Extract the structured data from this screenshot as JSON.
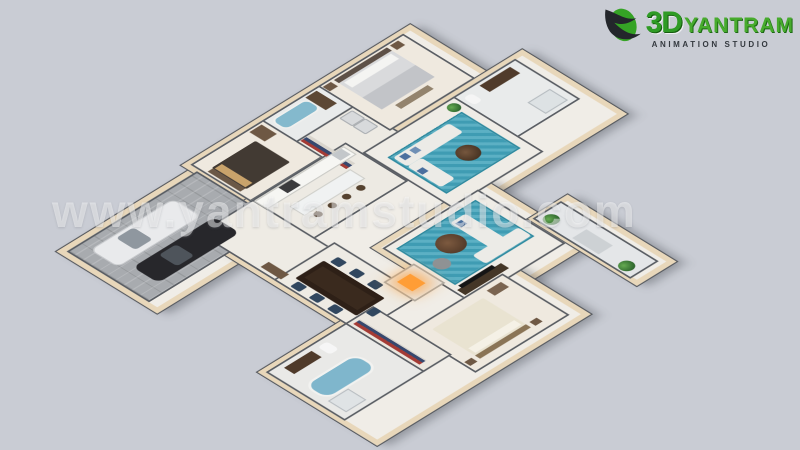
{
  "watermark": {
    "text": "www.yantramstudio.com"
  },
  "logo": {
    "number": "3D",
    "name": "YANTRAM",
    "tagline": "ANIMATION STUDIO"
  },
  "colors": {
    "background": "#c9ccd4",
    "exterior_wall": "#e8d7ba",
    "interior_wall": "#585c62",
    "floor_light": "#f0ede7",
    "garage_floor": "#a8abaf",
    "teal_rug": "#3f9cb3",
    "fire_glow": "#ff9d35",
    "logo_green": "#2f9b25",
    "watermark_white": "rgba(255,255,255,0.45)"
  },
  "scene": {
    "slabs": [
      {
        "name": "slab-garage-wing",
        "x": 20,
        "y": 15,
        "w": 270,
        "h": 178
      },
      {
        "name": "slab-bedroom-wing",
        "x": 280,
        "y": 0,
        "w": 430,
        "h": 192
      },
      {
        "name": "slab-family-wing",
        "x": 470,
        "y": 150,
        "w": 310,
        "h": 186
      },
      {
        "name": "slab-center-wing",
        "x": 180,
        "y": 118,
        "w": 300,
        "h": 332
      },
      {
        "name": "slab-living-wing",
        "x": 335,
        "y": 318,
        "w": 200,
        "h": 190
      },
      {
        "name": "slab-bottom-wing",
        "x": 25,
        "y": 405,
        "w": 400,
        "h": 215
      },
      {
        "name": "slab-porch",
        "x": 535,
        "y": 426,
        "w": 58,
        "h": 194
      }
    ],
    "rooms": [
      {
        "name": "room-garage",
        "x": 30,
        "y": 25,
        "w": 250,
        "h": 156,
        "cls": "pavers"
      },
      {
        "name": "room-bedroom-2",
        "x": 290,
        "y": 8,
        "w": 140,
        "h": 112,
        "bg": "#efe9df"
      },
      {
        "name": "room-bath-3",
        "x": 430,
        "y": 8,
        "w": 112,
        "h": 66,
        "bg": "#e9ebeb"
      },
      {
        "name": "room-laundry-hall",
        "x": 430,
        "y": 74,
        "w": 112,
        "h": 110,
        "bg": "#edeae3"
      },
      {
        "name": "room-master-bedroom",
        "x": 540,
        "y": 8,
        "w": 162,
        "h": 136,
        "bg": "#efe9df"
      },
      {
        "name": "room-bathroom-1",
        "x": 655,
        "y": 158,
        "w": 117,
        "h": 122,
        "bg": "#e9ebeb"
      },
      {
        "name": "room-family",
        "x": 478,
        "y": 158,
        "w": 174,
        "h": 170,
        "bg": "#efece6"
      },
      {
        "name": "room-kitchen",
        "x": 290,
        "y": 125,
        "w": 182,
        "h": 117,
        "bg": "#edeae3"
      },
      {
        "name": "room-entry-hall",
        "x": 188,
        "y": 125,
        "w": 102,
        "h": 212,
        "bg": "#eeebe4"
      },
      {
        "name": "room-dining",
        "x": 188,
        "y": 273,
        "w": 114,
        "h": 164,
        "bg": "#eeebe4"
      },
      {
        "name": "room-living",
        "x": 345,
        "y": 330,
        "w": 182,
        "h": 166,
        "bg": "#efece6"
      },
      {
        "name": "room-bedroom-3",
        "x": 238,
        "y": 488,
        "w": 179,
        "h": 126,
        "bg": "#efe9df"
      },
      {
        "name": "room-bathroom-2",
        "x": 33,
        "y": 413,
        "w": 155,
        "h": 149,
        "bg": "#e9e9e7"
      },
      {
        "name": "room-closet",
        "x": 188,
        "y": 413,
        "w": 50,
        "h": 149,
        "bg": "#ece8e0"
      },
      {
        "name": "room-porch",
        "x": 540,
        "y": 430,
        "w": 50,
        "h": 186,
        "bg": "#e4e6e8"
      }
    ],
    "furniture": [
      {
        "name": "car-white",
        "x": 55,
        "y": 45,
        "w": 160,
        "h": 52,
        "bg": "#e9eaec",
        "rad": 12,
        "border": "2px solid #c8cacd"
      },
      {
        "name": "car-white-windshield",
        "x": 100,
        "y": 52,
        "w": 34,
        "h": 38,
        "bg": "#8f979f",
        "rad": 6
      },
      {
        "name": "car-black",
        "x": 70,
        "y": 115,
        "w": 160,
        "h": 50,
        "bg": "#27272b",
        "rad": 12
      },
      {
        "name": "car-black-windshield",
        "x": 115,
        "y": 121,
        "w": 34,
        "h": 36,
        "bg": "#4e545b",
        "rad": 6
      },
      {
        "name": "bed-2-headboard",
        "x": 296,
        "y": 36,
        "w": 10,
        "h": 64,
        "bg": "#6b5846"
      },
      {
        "name": "bed-2",
        "x": 306,
        "y": 34,
        "w": 86,
        "h": 68,
        "bg": "#423a33",
        "rad": 3
      },
      {
        "name": "bed-2-pillows",
        "x": 308,
        "y": 38,
        "w": 14,
        "h": 60,
        "bg": "#c9a36b"
      },
      {
        "name": "bed-2-cabinet",
        "x": 400,
        "y": 14,
        "w": 24,
        "h": 30,
        "bg": "#6e5844"
      },
      {
        "name": "tub-3",
        "x": 438,
        "y": 16,
        "w": 66,
        "h": 26,
        "bg": "#84b9cd",
        "rad": 12,
        "border": "3px solid #f0f0ee"
      },
      {
        "name": "vanity-3",
        "x": 510,
        "y": 14,
        "w": 22,
        "h": 40,
        "bg": "#5c4734"
      },
      {
        "name": "closet-rack-top",
        "x": 436,
        "y": 78,
        "w": 18,
        "h": 90,
        "cls": "stripes"
      },
      {
        "name": "washer",
        "x": 510,
        "y": 80,
        "w": 22,
        "h": 22,
        "bg": "#d8dadc",
        "rad": 3,
        "border": "2px solid #a9adb1"
      },
      {
        "name": "dryer",
        "x": 510,
        "y": 106,
        "w": 22,
        "h": 22,
        "bg": "#d8dadc",
        "rad": 3,
        "border": "2px solid #a9adb1"
      },
      {
        "name": "master-bed-headboard",
        "x": 566,
        "y": 14,
        "w": 104,
        "h": 10,
        "bg": "#5d5047"
      },
      {
        "name": "master-bed",
        "x": 566,
        "y": 24,
        "w": 104,
        "h": 84,
        "bg": "#d9dadc",
        "rad": 3
      },
      {
        "name": "master-bed-pillows",
        "x": 572,
        "y": 28,
        "w": 92,
        "h": 16,
        "bg": "#f4f4f2"
      },
      {
        "name": "master-bed-blanket",
        "x": 566,
        "y": 70,
        "w": 104,
        "h": 38,
        "bg": "#c2c4c8"
      },
      {
        "name": "master-nightstand-left",
        "x": 544,
        "y": 14,
        "w": 16,
        "h": 14,
        "bg": "#6e5844"
      },
      {
        "name": "master-nightstand-right",
        "x": 676,
        "y": 14,
        "w": 16,
        "h": 14,
        "bg": "#6e5844"
      },
      {
        "name": "master-bench",
        "x": 586,
        "y": 114,
        "w": 64,
        "h": 12,
        "bg": "#93836d"
      },
      {
        "name": "vanity-1",
        "x": 700,
        "y": 166,
        "w": 60,
        "h": 20,
        "bg": "#503b2b"
      },
      {
        "name": "toilet-1",
        "x": 664,
        "y": 170,
        "w": 16,
        "h": 22,
        "bg": "#f5f5f5",
        "rad": 6
      },
      {
        "name": "shower-1",
        "x": 720,
        "y": 240,
        "w": 40,
        "h": 32,
        "bg": "#dde2e4",
        "border": "2px solid #b6bcc0"
      },
      {
        "name": "family-rug",
        "x": 495,
        "y": 190,
        "w": 140,
        "h": 110,
        "cls": "rug"
      },
      {
        "name": "family-sofa-long",
        "x": 500,
        "y": 196,
        "w": 110,
        "h": 28,
        "bg": "#ecebe7",
        "rad": 5
      },
      {
        "name": "family-sofa-side",
        "x": 500,
        "y": 224,
        "w": 28,
        "h": 66,
        "bg": "#ecebe7",
        "rad": 5
      },
      {
        "name": "family-pillow-1",
        "x": 508,
        "y": 200,
        "w": 12,
        "h": 12,
        "bg": "#4a6f9e"
      },
      {
        "name": "family-pillow-2",
        "x": 528,
        "y": 200,
        "w": 12,
        "h": 12,
        "bg": "#6f8fb5"
      },
      {
        "name": "family-pillow-3",
        "x": 502,
        "y": 240,
        "w": 12,
        "h": 12,
        "bg": "#4a6f9e"
      },
      {
        "name": "family-coffee-table",
        "x": 564,
        "y": 244,
        "w": 36,
        "h": 36,
        "rad": 18,
        "cls": "table-round"
      },
      {
        "name": "plant-family-corner",
        "x": 630,
        "y": 166,
        "w": 20,
        "h": 20,
        "cls": "plant"
      },
      {
        "name": "kitchen-counter",
        "x": 294,
        "y": 129,
        "w": 172,
        "h": 22,
        "bg": "#f6f6f3",
        "border": "2px solid #c9c9c4"
      },
      {
        "name": "kitchen-stove",
        "x": 340,
        "y": 131,
        "w": 26,
        "h": 18,
        "bg": "#3b3b3d"
      },
      {
        "name": "kitchen-fridge",
        "x": 444,
        "y": 131,
        "w": 20,
        "h": 18,
        "bg": "#c3c7ca"
      },
      {
        "name": "kitchen-island",
        "x": 320,
        "y": 172,
        "w": 116,
        "h": 26,
        "bg": "#f0f2f2",
        "border": "2px solid #cfcfca"
      },
      {
        "name": "bar-stool-1",
        "x": 330,
        "y": 206,
        "w": 13,
        "h": 13,
        "bg": "#55422f",
        "rad": 7
      },
      {
        "name": "bar-stool-2",
        "x": 358,
        "y": 206,
        "w": 13,
        "h": 13,
        "bg": "#55422f",
        "rad": 7
      },
      {
        "name": "bar-stool-3",
        "x": 386,
        "y": 206,
        "w": 13,
        "h": 13,
        "bg": "#55422f",
        "rad": 7
      },
      {
        "name": "bar-stool-4",
        "x": 414,
        "y": 206,
        "w": 13,
        "h": 13,
        "bg": "#55422f",
        "rad": 7
      },
      {
        "name": "entry-console",
        "x": 196,
        "y": 240,
        "w": 16,
        "h": 40,
        "bg": "#6e5844"
      },
      {
        "name": "dining-table",
        "x": 212,
        "y": 292,
        "w": 56,
        "h": 120,
        "bg": "#2e2017",
        "rad": 3
      },
      {
        "name": "dining-runner",
        "x": 222,
        "y": 300,
        "w": 36,
        "h": 104,
        "bg": "#3a2a1e"
      },
      {
        "name": "dining-chair-l1",
        "x": 194,
        "y": 300,
        "w": 16,
        "h": 18,
        "bg": "#31475f",
        "rad": 3
      },
      {
        "name": "dining-chair-l2",
        "x": 194,
        "y": 336,
        "w": 16,
        "h": 18,
        "bg": "#31475f",
        "rad": 3
      },
      {
        "name": "dining-chair-l3",
        "x": 194,
        "y": 372,
        "w": 16,
        "h": 18,
        "bg": "#31475f",
        "rad": 3
      },
      {
        "name": "dining-chair-r1",
        "x": 272,
        "y": 300,
        "w": 16,
        "h": 18,
        "bg": "#31475f",
        "rad": 3
      },
      {
        "name": "dining-chair-r2",
        "x": 272,
        "y": 336,
        "w": 16,
        "h": 18,
        "bg": "#31475f",
        "rad": 3
      },
      {
        "name": "dining-chair-r3",
        "x": 272,
        "y": 372,
        "w": 16,
        "h": 18,
        "bg": "#31475f",
        "rad": 3
      },
      {
        "name": "dining-chair-head",
        "x": 226,
        "y": 416,
        "w": 18,
        "h": 14,
        "bg": "#31475f",
        "rad": 3
      },
      {
        "name": "fireplace",
        "x": 292,
        "y": 385,
        "w": 54,
        "h": 56,
        "bg": "#e9e9e7",
        "border": "3px solid #a9a9a6",
        "z": 4
      },
      {
        "name": "fireplace-fire",
        "x": 306,
        "y": 398,
        "w": 26,
        "h": 30,
        "bg": "#ff9d35",
        "z": 5,
        "shadow": "0 0 26px 10px rgba(255,160,60,.75)"
      },
      {
        "name": "living-rug",
        "x": 358,
        "y": 344,
        "w": 150,
        "h": 110,
        "cls": "rug"
      },
      {
        "name": "living-ottoman",
        "x": 398,
        "y": 368,
        "w": 44,
        "h": 44,
        "rad": 22,
        "cls": "ottoman"
      },
      {
        "name": "living-pouf",
        "x": 366,
        "y": 400,
        "w": 26,
        "h": 26,
        "bg": "#8f9294",
        "rad": 13
      },
      {
        "name": "living-sofa-side",
        "x": 452,
        "y": 356,
        "w": 30,
        "h": 90,
        "bg": "#ecebe7",
        "rad": 5
      },
      {
        "name": "living-sofa-bottom",
        "x": 422,
        "y": 430,
        "w": 90,
        "h": 26,
        "bg": "#ecebe7",
        "rad": 5
      },
      {
        "name": "living-pillow",
        "x": 456,
        "y": 362,
        "w": 12,
        "h": 12,
        "bg": "#4a6f9e"
      },
      {
        "name": "tv-console",
        "x": 352,
        "y": 470,
        "w": 86,
        "h": 16,
        "bg": "#443627"
      },
      {
        "name": "tv-screen",
        "x": 360,
        "y": 464,
        "w": 66,
        "h": 8,
        "bg": "#151515"
      },
      {
        "name": "bed-3",
        "x": 265,
        "y": 508,
        "w": 100,
        "h": 84,
        "bg": "#e9e3d1",
        "rad": 3
      },
      {
        "name": "bed-3-pillows",
        "x": 270,
        "y": 574,
        "w": 90,
        "h": 14,
        "bg": "#f5f1e6"
      },
      {
        "name": "bed-3-headboard",
        "x": 265,
        "y": 592,
        "w": 100,
        "h": 10,
        "bg": "#8a7456"
      },
      {
        "name": "bed-3-nightstand-left",
        "x": 244,
        "y": 592,
        "w": 14,
        "h": 12,
        "bg": "#6e5844"
      },
      {
        "name": "bed-3-nightstand-right",
        "x": 372,
        "y": 592,
        "w": 14,
        "h": 12,
        "bg": "#6e5844"
      },
      {
        "name": "bed-3-dresser",
        "x": 380,
        "y": 500,
        "w": 28,
        "h": 16,
        "bg": "#7a6450"
      },
      {
        "name": "closet-rack",
        "x": 196,
        "y": 422,
        "w": 14,
        "h": 130,
        "cls": "stripes"
      },
      {
        "name": "tub-2",
        "x": 48,
        "y": 470,
        "w": 96,
        "h": 40,
        "bg": "#7fb6cc",
        "rad": 20,
        "border": "4px solid #f2f2f0"
      },
      {
        "name": "vanity-2",
        "x": 58,
        "y": 424,
        "w": 54,
        "h": 20,
        "bg": "#4f3a2a"
      },
      {
        "name": "toilet-2",
        "x": 124,
        "y": 424,
        "w": 18,
        "h": 24,
        "bg": "#f6f6f6",
        "rad": 6
      },
      {
        "name": "shower-2",
        "x": 48,
        "y": 520,
        "w": 36,
        "h": 32,
        "bg": "#dfe3e5",
        "border": "2px solid #b9bec2"
      },
      {
        "name": "porch-plant-top",
        "x": 545,
        "y": 438,
        "w": 24,
        "h": 24,
        "cls": "plant"
      },
      {
        "name": "porch-plant-bottom",
        "x": 545,
        "y": 586,
        "w": 24,
        "h": 24,
        "cls": "plant"
      },
      {
        "name": "porch-bench",
        "x": 548,
        "y": 500,
        "w": 28,
        "h": 52,
        "bg": "#cdd1d4"
      }
    ]
  }
}
